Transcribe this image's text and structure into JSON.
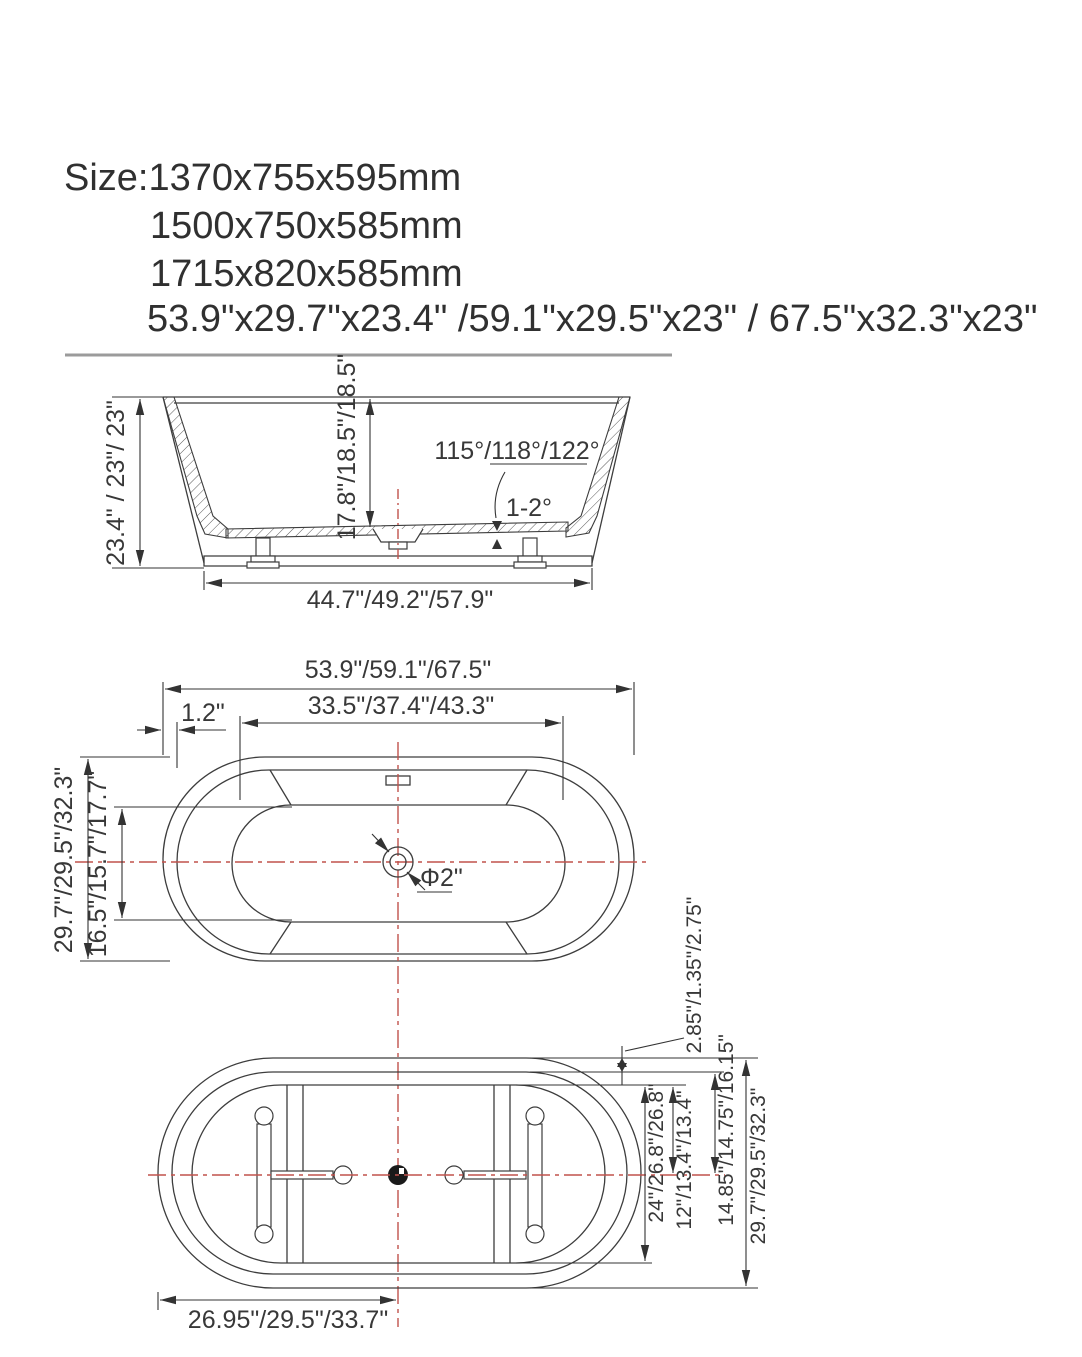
{
  "title": {
    "line1": "Size:1370x755x595mm",
    "line2": "1500x750x585mm",
    "line3": "1715x820x585mm",
    "line4": "53.9\"x29.7\"x23.4\" /59.1\"x29.5\"x23\" / 67.5\"x32.3\"x23\""
  },
  "side_view": {
    "height": "23.4\" / 23\"/ 23\"",
    "inner_depth": "17.8\"/18.5\"/18.5\"",
    "wall_angle": "115°/118°/122°",
    "floor_slope": "1-2°",
    "base_width": "44.7\"/49.2\"/57.9\""
  },
  "top_view": {
    "overall_length": "53.9\"/59.1\"/67.5\"",
    "inner_length": "33.5\"/37.4\"/43.3\"",
    "rim_width": "1.2\"",
    "overall_width": "29.7\"/29.5\"/32.3\"",
    "inner_width": "16.5\"/15.7\"/17.7\"",
    "drain_diameter": "Φ2\""
  },
  "bottom_view": {
    "rim_gap": "2.85\"/1.35\"/2.75\"",
    "inner_width": "24\"/26.8\"/26.8\"",
    "center_to_inner": "12\"/13.4\"/13.4\"",
    "center_to_rim": "14.85\"/14.75\"/16.15\"",
    "overall_width": "29.7\"/29.5\"/32.3\"",
    "end_to_center": "26.95\"/29.5\"/33.7\""
  },
  "colors": {
    "line": "#3d3d3d",
    "centerline_red": "#c0524c",
    "divider_gray": "#9b9b9b",
    "text": "#383838"
  }
}
